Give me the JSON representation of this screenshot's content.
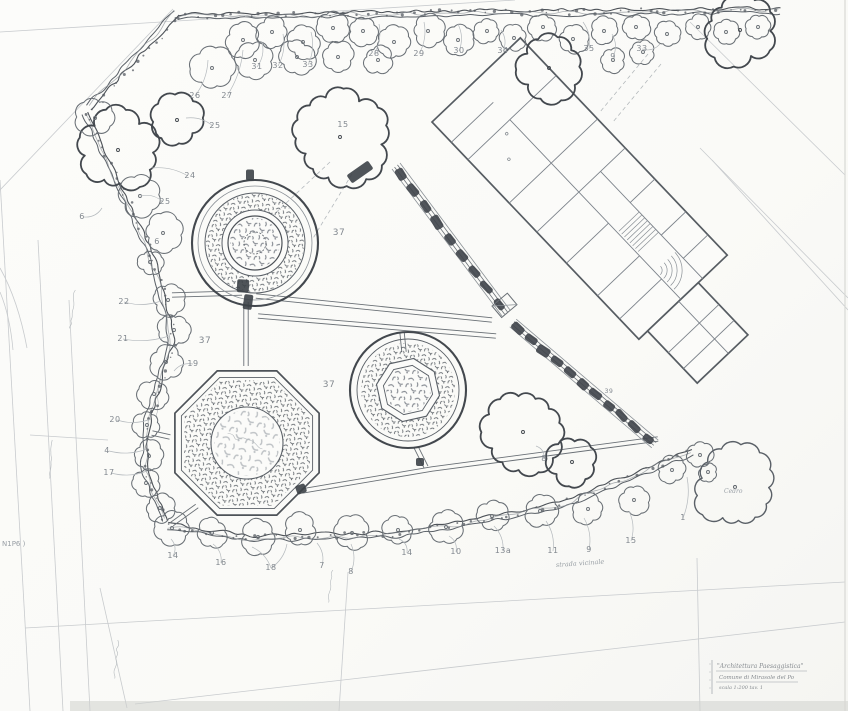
{
  "meta": {
    "kind": "scanned hand-drawn landscape site plan (pencil)",
    "canvas": {
      "w": 848,
      "h": 711
    }
  },
  "palette": {
    "paper": "#fbfbf9",
    "ink_dark": "#43484e",
    "ink_mid": "#5a6067",
    "ink_soft": "#6a7076",
    "ink_light": "#8a9096",
    "ink_faint": "#b4b9bd",
    "ink_ghost": "#c8cbce",
    "stip1": "#4a5057",
    "stip2": "#6b717a",
    "stip3": "#959ba2",
    "band": "#d0d1cd"
  },
  "plant_labels": [
    {
      "t": "26",
      "x": 195,
      "y": 98
    },
    {
      "t": "27",
      "x": 227,
      "y": 98
    },
    {
      "t": "31",
      "x": 257,
      "y": 69
    },
    {
      "t": "32",
      "x": 278,
      "y": 68
    },
    {
      "t": "33",
      "x": 308,
      "y": 67
    },
    {
      "t": "28",
      "x": 374,
      "y": 56
    },
    {
      "t": "29",
      "x": 419,
      "y": 56
    },
    {
      "t": "30",
      "x": 459,
      "y": 53
    },
    {
      "t": "34",
      "x": 503,
      "y": 53
    },
    {
      "t": "35",
      "x": 589,
      "y": 51
    },
    {
      "t": "9",
      "x": 613,
      "y": 59
    },
    {
      "t": "33",
      "x": 642,
      "y": 51
    },
    {
      "t": "15",
      "x": 343,
      "y": 127
    },
    {
      "t": "25",
      "x": 215,
      "y": 128
    },
    {
      "t": "24",
      "x": 190,
      "y": 178
    },
    {
      "t": "25",
      "x": 165,
      "y": 204
    },
    {
      "t": "6",
      "x": 82,
      "y": 219
    },
    {
      "t": "6",
      "x": 157,
      "y": 244
    },
    {
      "t": "22",
      "x": 124,
      "y": 304
    },
    {
      "t": "21",
      "x": 123,
      "y": 341
    },
    {
      "t": "19",
      "x": 193,
      "y": 366
    },
    {
      "t": "20",
      "x": 115,
      "y": 422
    },
    {
      "t": "4",
      "x": 107,
      "y": 453
    },
    {
      "t": "17",
      "x": 109,
      "y": 475
    },
    {
      "t": "37",
      "x": 339,
      "y": 235,
      "fs": 9
    },
    {
      "t": "37",
      "x": 205,
      "y": 343,
      "fs": 9
    },
    {
      "t": "37",
      "x": 329,
      "y": 387,
      "fs": 9
    },
    {
      "t": "14",
      "x": 173,
      "y": 558
    },
    {
      "t": "16",
      "x": 221,
      "y": 565
    },
    {
      "t": "18",
      "x": 271,
      "y": 570
    },
    {
      "t": "7",
      "x": 322,
      "y": 568
    },
    {
      "t": "8",
      "x": 351,
      "y": 574
    },
    {
      "t": "14",
      "x": 407,
      "y": 555
    },
    {
      "t": "10",
      "x": 456,
      "y": 554
    },
    {
      "t": "13a",
      "x": 503,
      "y": 553
    },
    {
      "t": "11",
      "x": 553,
      "y": 553
    },
    {
      "t": "9",
      "x": 589,
      "y": 552
    },
    {
      "t": "15",
      "x": 631,
      "y": 543
    },
    {
      "t": "1",
      "x": 683,
      "y": 520
    },
    {
      "t": "8",
      "x": 544,
      "y": 461
    },
    {
      "t": "39",
      "x": 609,
      "y": 393,
      "fs": 6
    }
  ],
  "annotations": [
    {
      "t": "N1P6 )",
      "x": 2,
      "y": 546,
      "fs": 7,
      "it": false,
      "rot": 0,
      "anchor": "start"
    },
    {
      "t": "strada vicinale",
      "x": 556,
      "y": 567,
      "fs": 6.5,
      "it": true,
      "rot": -4,
      "anchor": "start"
    },
    {
      "t": "Cedro",
      "x": 724,
      "y": 493,
      "fs": 6,
      "it": true,
      "rot": 0,
      "anchor": "start"
    }
  ],
  "title_block": {
    "note": "tiny faint handwriting, approximate transcription",
    "lines": [
      {
        "t": "\"Architettura Paesaggistica\"",
        "x": 717,
        "y": 668,
        "fs": 6
      },
      {
        "t": "Comune di Mirasole del Po",
        "x": 719,
        "y": 679,
        "fs": 5.5
      },
      {
        "t": "scala 1:200    tav.  1",
        "x": 719,
        "y": 689,
        "fs": 5
      }
    ],
    "underlines": [
      [
        716,
        671,
        807,
        671
      ],
      [
        716,
        682,
        798,
        682
      ]
    ],
    "side_bar": [
      712,
      660,
      712,
      694
    ]
  },
  "leaders": [
    [
      195,
      96,
      208,
      60
    ],
    [
      227,
      96,
      243,
      50
    ],
    [
      257,
      67,
      262,
      42
    ],
    [
      278,
      66,
      283,
      34
    ],
    [
      308,
      65,
      311,
      32
    ],
    [
      374,
      54,
      379,
      24
    ],
    [
      419,
      54,
      424,
      22
    ],
    [
      459,
      51,
      458,
      24
    ],
    [
      503,
      51,
      501,
      30
    ],
    [
      589,
      49,
      583,
      22
    ],
    [
      613,
      57,
      612,
      34
    ],
    [
      642,
      49,
      660,
      44
    ],
    [
      213,
      126,
      186,
      118
    ],
    [
      188,
      176,
      152,
      168
    ],
    [
      163,
      202,
      141,
      196
    ],
    [
      84,
      217,
      102,
      208
    ],
    [
      124,
      302,
      161,
      301
    ],
    [
      123,
      339,
      169,
      336
    ],
    [
      193,
      364,
      174,
      371
    ],
    [
      117,
      420,
      151,
      419
    ],
    [
      109,
      451,
      147,
      449
    ],
    [
      111,
      473,
      147,
      471
    ],
    [
      173,
      556,
      171,
      539
    ],
    [
      221,
      563,
      213,
      544
    ],
    [
      271,
      568,
      252,
      547
    ],
    [
      271,
      568,
      287,
      544
    ],
    [
      322,
      566,
      317,
      543
    ],
    [
      351,
      572,
      351,
      544
    ],
    [
      407,
      553,
      399,
      539
    ],
    [
      456,
      552,
      449,
      536
    ],
    [
      503,
      551,
      494,
      526
    ],
    [
      553,
      551,
      546,
      521
    ],
    [
      589,
      550,
      584,
      518
    ],
    [
      631,
      541,
      629,
      511
    ],
    [
      683,
      518,
      687,
      477
    ],
    [
      544,
      459,
      536,
      446
    ]
  ],
  "trees": [
    [
      243,
      40,
      17,
      0
    ],
    [
      272,
      32,
      15,
      0
    ],
    [
      303,
      42,
      16,
      0
    ],
    [
      333,
      28,
      15,
      0
    ],
    [
      363,
      31,
      14,
      0
    ],
    [
      394,
      42,
      15,
      0
    ],
    [
      428,
      31,
      15,
      0
    ],
    [
      458,
      40,
      14,
      0
    ],
    [
      487,
      31,
      13,
      0
    ],
    [
      514,
      38,
      13,
      0
    ],
    [
      543,
      27,
      13,
      0
    ],
    [
      573,
      39,
      14,
      0
    ],
    [
      604,
      31,
      13,
      0
    ],
    [
      636,
      27,
      13,
      0
    ],
    [
      667,
      34,
      13,
      0
    ],
    [
      698,
      27,
      12,
      0
    ],
    [
      726,
      32,
      12,
      0
    ],
    [
      758,
      27,
      12,
      0
    ],
    [
      212,
      68,
      21,
      0
    ],
    [
      255,
      60,
      18,
      0
    ],
    [
      297,
      57,
      17,
      0
    ],
    [
      338,
      57,
      15,
      0
    ],
    [
      378,
      60,
      14,
      0
    ],
    [
      613,
      60,
      12,
      0
    ],
    [
      643,
      52,
      12,
      0
    ],
    [
      340,
      137,
      47,
      1
    ],
    [
      549,
      68,
      32,
      1
    ],
    [
      740,
      30,
      35,
      1
    ],
    [
      118,
      150,
      40,
      1
    ],
    [
      177,
      120,
      24,
      1
    ],
    [
      95,
      118,
      18,
      0
    ],
    [
      140,
      196,
      21,
      0
    ],
    [
      163,
      233,
      18,
      0
    ],
    [
      150,
      262,
      12,
      0
    ],
    [
      168,
      300,
      15,
      0
    ],
    [
      174,
      330,
      15,
      0
    ],
    [
      166,
      362,
      16,
      0
    ],
    [
      154,
      394,
      15,
      0
    ],
    [
      147,
      425,
      13,
      0
    ],
    [
      149,
      456,
      15,
      0
    ],
    [
      146,
      483,
      13,
      0
    ],
    [
      160,
      508,
      14,
      0
    ],
    [
      172,
      528,
      16,
      0
    ],
    [
      212,
      533,
      15,
      0
    ],
    [
      258,
      537,
      17,
      0
    ],
    [
      300,
      530,
      16,
      0
    ],
    [
      352,
      533,
      16,
      0
    ],
    [
      398,
      530,
      15,
      0
    ],
    [
      446,
      527,
      16,
      0
    ],
    [
      492,
      516,
      15,
      0
    ],
    [
      540,
      511,
      16,
      0
    ],
    [
      588,
      509,
      15,
      0
    ],
    [
      634,
      500,
      15,
      0
    ],
    [
      672,
      470,
      13,
      0
    ],
    [
      700,
      455,
      13,
      0
    ],
    [
      708,
      472,
      9,
      0
    ],
    [
      523,
      432,
      40,
      1
    ],
    [
      572,
      462,
      24,
      1
    ],
    [
      735,
      487,
      41,
      2
    ]
  ],
  "hedges": [
    [
      [
        178,
        14
      ],
      [
        430,
        11
      ],
      [
        784,
        8
      ]
    ],
    [
      [
        178,
        14
      ],
      [
        88,
        112
      ]
    ],
    [
      [
        88,
        112
      ],
      [
        108,
        158
      ],
      [
        132,
        208
      ],
      [
        152,
        252
      ],
      [
        166,
        298
      ],
      [
        174,
        340
      ],
      [
        160,
        385
      ],
      [
        148,
        428
      ],
      [
        147,
        468
      ],
      [
        158,
        500
      ],
      [
        168,
        524
      ]
    ],
    [
      [
        168,
        524
      ],
      [
        250,
        536
      ],
      [
        400,
        532
      ],
      [
        560,
        503
      ],
      [
        695,
        448
      ]
    ]
  ],
  "walks": [
    [
      [
        172,
        295
      ],
      [
        242,
        293
      ]
    ],
    [
      [
        246,
        302
      ],
      [
        246,
        366
      ]
    ],
    [
      [
        256,
        296
      ],
      [
        492,
        320
      ]
    ],
    [
      [
        258,
        316
      ],
      [
        496,
        336
      ]
    ],
    [
      [
        402,
        332
      ],
      [
        404,
        352
      ]
    ],
    [
      [
        416,
        447
      ],
      [
        426,
        467
      ]
    ],
    [
      [
        302,
        491
      ],
      [
        432,
        469
      ],
      [
        658,
        439
      ]
    ],
    [
      [
        170,
        437
      ],
      [
        152,
        433
      ]
    ],
    [
      [
        197,
        506
      ],
      [
        172,
        524
      ]
    ]
  ],
  "beds": {
    "a": {
      "cx": 255,
      "cy": 243
    },
    "b": {
      "cx": 408,
      "cy": 390
    },
    "c": {
      "cx": 247,
      "cy": 443,
      "rot": 22.5
    }
  },
  "building": {
    "origin": [
      432,
      122
    ],
    "angle": -43.6,
    "rects": [
      [
        0,
        0,
        122,
        300
      ],
      [
        12,
        300,
        70,
        72
      ]
    ],
    "walls": [
      [
        0,
        28,
        58,
        28
      ],
      [
        0,
        52,
        122,
        52
      ],
      [
        0,
        112,
        122,
        112
      ],
      [
        0,
        152,
        122,
        152
      ],
      [
        58,
        52,
        58,
        152
      ],
      [
        58,
        152,
        58,
        300
      ],
      [
        88,
        152,
        88,
        300
      ],
      [
        0,
        195,
        58,
        195
      ],
      [
        88,
        195,
        122,
        195
      ],
      [
        0,
        240,
        58,
        240
      ],
      [
        88,
        240,
        122,
        240
      ],
      [
        0,
        272,
        58,
        272
      ],
      [
        88,
        272,
        122,
        272
      ],
      [
        12,
        330,
        82,
        330
      ],
      [
        12,
        352,
        82,
        352
      ],
      [
        55,
        300,
        55,
        372
      ]
    ],
    "stairs": {
      "x": 60,
      "y": 208,
      "w": 28,
      "n": 8,
      "dy": 4
    },
    "fan": {
      "cx": 60,
      "cy": 262,
      "r0": 6,
      "r1": 26,
      "n": 5
    },
    "dots": [
      [
        30,
        80
      ],
      [
        46,
        60
      ]
    ]
  },
  "pergolas": [
    {
      "a": [
        396,
        166
      ],
      "b": [
        506,
        313
      ],
      "n": 9
    },
    {
      "a": [
        513,
        323
      ],
      "b": [
        655,
        444
      ],
      "n": 11
    }
  ],
  "gate": {
    "x": 492,
    "y": 306,
    "w": 20,
    "h": 15,
    "rot": -40
  },
  "blobs": [
    [
      243,
      286,
      12,
      13,
      3
    ],
    [
      248,
      302,
      9,
      15,
      8
    ],
    [
      250,
      175,
      8,
      11,
      0
    ],
    [
      301,
      489,
      10,
      9,
      -20
    ],
    [
      420,
      462,
      8,
      8,
      0
    ],
    [
      360,
      172,
      26,
      10,
      -35
    ]
  ],
  "faint_lines": [
    [
      0,
      32,
      515,
      0
    ],
    [
      0,
      190,
      173,
      9
    ],
    [
      0,
      180,
      30,
      711
    ],
    [
      38,
      240,
      63,
      711
    ],
    [
      69,
      300,
      90,
      711
    ],
    [
      100,
      588,
      127,
      708
    ],
    [
      30,
      435,
      108,
      440
    ],
    [
      25,
      628,
      845,
      582
    ],
    [
      135,
      704,
      845,
      622
    ],
    [
      697,
      558,
      700,
      711
    ],
    [
      700,
      148,
      848,
      298
    ],
    [
      712,
      160,
      848,
      310
    ],
    [
      690,
      22,
      845,
      175
    ],
    [
      348,
      572,
      339,
      711
    ]
  ],
  "dashed_lines": [
    [
      648,
      54,
      600,
      112
    ],
    [
      661,
      64,
      613,
      122
    ],
    [
      330,
      162,
      268,
      220
    ],
    [
      352,
      174,
      312,
      240
    ]
  ],
  "curves": [
    "M0,268 Q18,300 27,348",
    "M0,292 Q10,316 13,350"
  ],
  "squiggles": [
    [
      75,
      290,
      70,
      330
    ],
    [
      160,
      380,
      156,
      420
    ],
    [
      118,
      640,
      114,
      680
    ],
    [
      52,
      440,
      49,
      480
    ],
    [
      332,
      570,
      328,
      604
    ]
  ]
}
